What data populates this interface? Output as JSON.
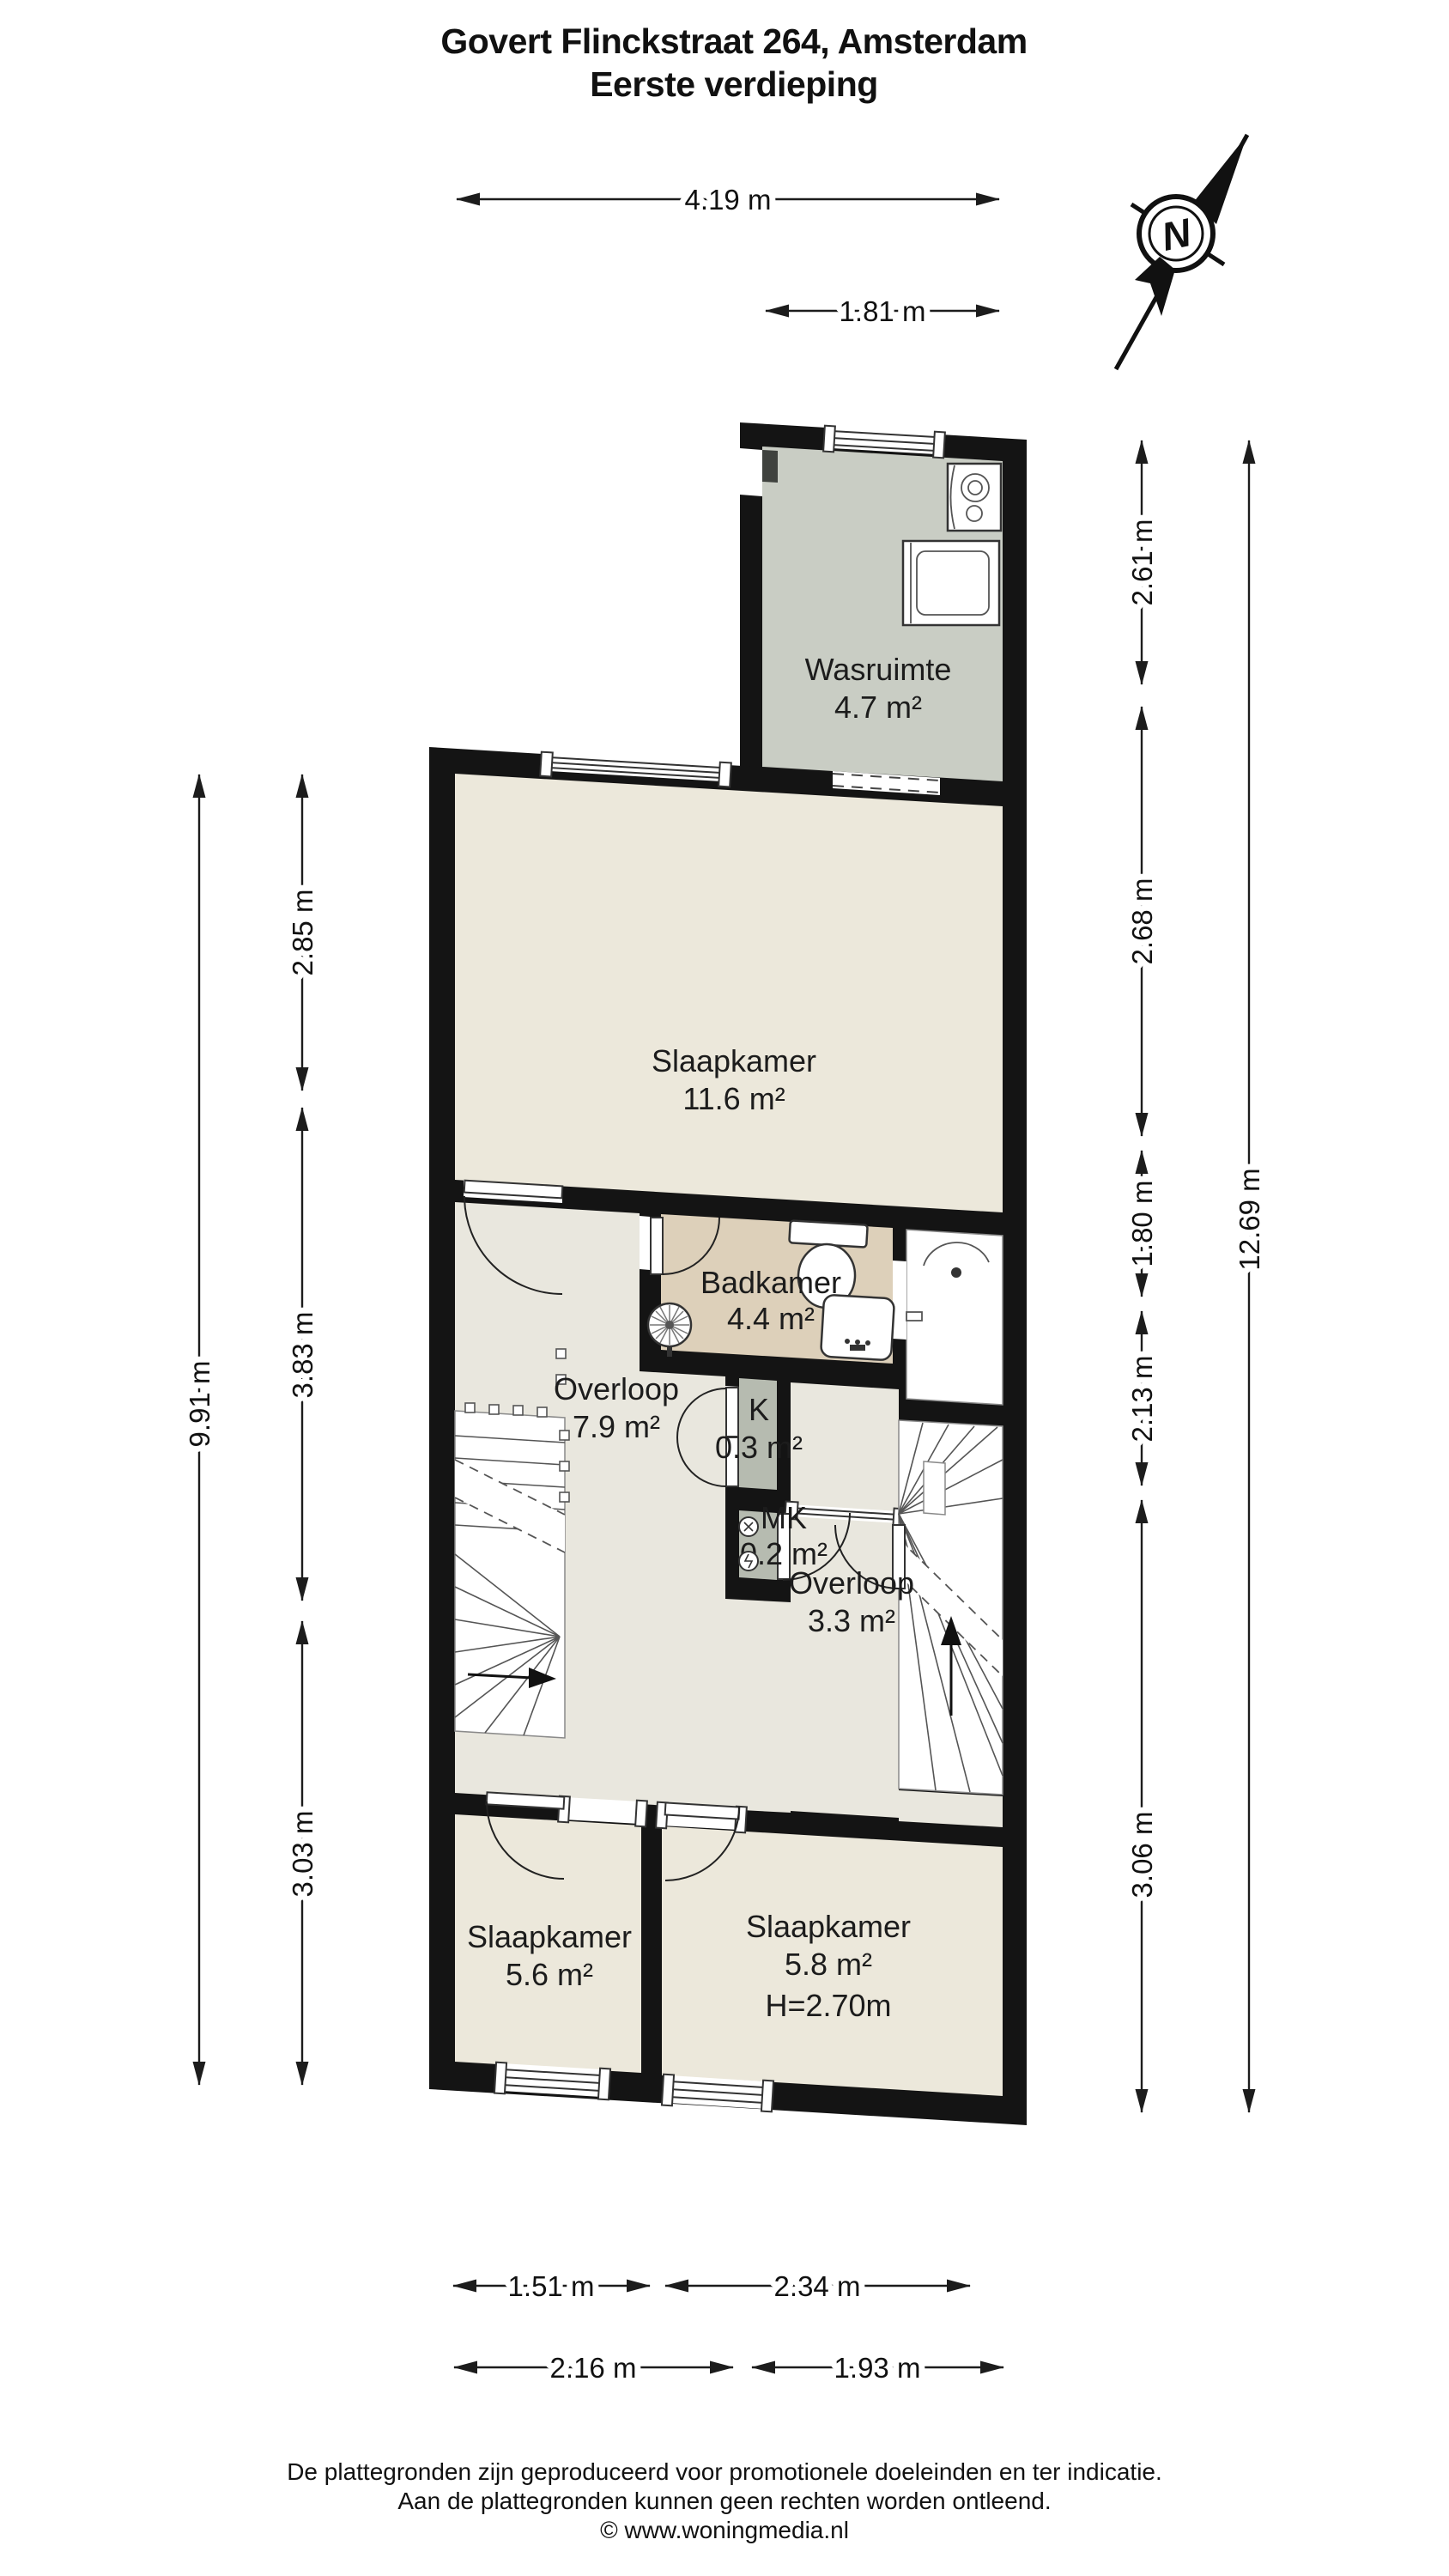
{
  "title": {
    "line1": "Govert Flinckstraat 264, Amsterdam",
    "line2": "Eerste verdieping"
  },
  "compass": {
    "label": "N"
  },
  "rooms": {
    "wasruimte": {
      "name": "Wasruimte",
      "area": "4.7 m²"
    },
    "slaapkamer_boven": {
      "name": "Slaapkamer",
      "area": "11.6 m²"
    },
    "badkamer": {
      "name": "Badkamer",
      "area": "4.4 m²"
    },
    "overloop_groot": {
      "name": "Overloop",
      "area": "7.9 m²"
    },
    "kast": {
      "name": "K",
      "area": "0.3 m²"
    },
    "meterkast": {
      "name": "MK",
      "area": "0.2 m²"
    },
    "overloop_klein": {
      "name": "Overloop",
      "area": "3.3 m²"
    },
    "slaapkamer_links": {
      "name": "Slaapkamer",
      "area": "5.6 m²"
    },
    "slaapkamer_rechts": {
      "name": "Slaapkamer",
      "area": "5.8 m²",
      "height": "H=2.70m"
    }
  },
  "dimensions": {
    "top_outer": "4.19 m",
    "top_inner": "1.81 m",
    "left_outer": "9.91 m",
    "left_seg1": "2.85 m",
    "left_seg2": "3.83 m",
    "left_seg3": "3.03 m",
    "right_seg1": "2.61 m",
    "right_seg2": "2.68 m",
    "right_seg3": "1.80 m",
    "right_seg4": "2.13 m",
    "right_seg5": "3.06 m",
    "right_outer": "12.69 m",
    "bottom_inner_left": "1.51 m",
    "bottom_inner_right": "2.34 m",
    "bottom_outer_left": "2.16 m",
    "bottom_outer_right": "1.93 m"
  },
  "footer": {
    "line1": "De plattegronden zijn geproduceerd voor promotionele doeleinden en ter indicatie.",
    "line2": "Aan de plattegronden kunnen geen rechten worden ontleend.",
    "line3": "© www.woningmedia.nl"
  },
  "icons": [
    "compass-north-icon",
    "toilet-icon",
    "sink-icon",
    "shower-icon",
    "towel-radiator-icon",
    "washing-machine-icon",
    "boiler-icon",
    "stairs-icon",
    "window-icon",
    "door-icon"
  ],
  "colors": {
    "wall": "#141414",
    "floor-room": "#ece8db",
    "floor-hall": "#e9e7de",
    "floor-bath": "#ddd0ba",
    "floor-laundry": "#c9cdc4",
    "floor-closet": "#b6bbb0"
  }
}
